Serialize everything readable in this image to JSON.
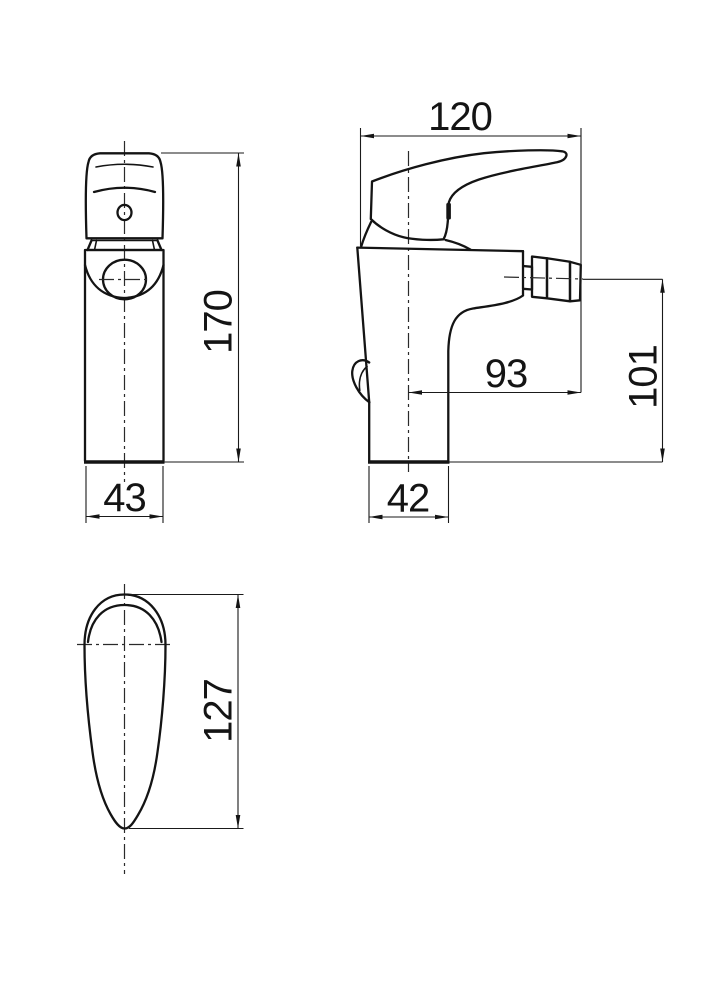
{
  "drawing": {
    "subject": "single-lever bidet mixer tap",
    "line_color": "#141414",
    "background_color": "#ffffff",
    "views": {
      "front": {
        "name": "front view",
        "dimensions": {
          "overall_height": "170",
          "body_width": "43"
        }
      },
      "side": {
        "name": "side view",
        "dimensions": {
          "overall_length": "120",
          "spout_projection": "93",
          "spout_height": "101",
          "base_depth": "42"
        }
      },
      "handle_plan": {
        "name": "handle plan view",
        "dimensions": {
          "handle_length": "127"
        }
      }
    }
  }
}
